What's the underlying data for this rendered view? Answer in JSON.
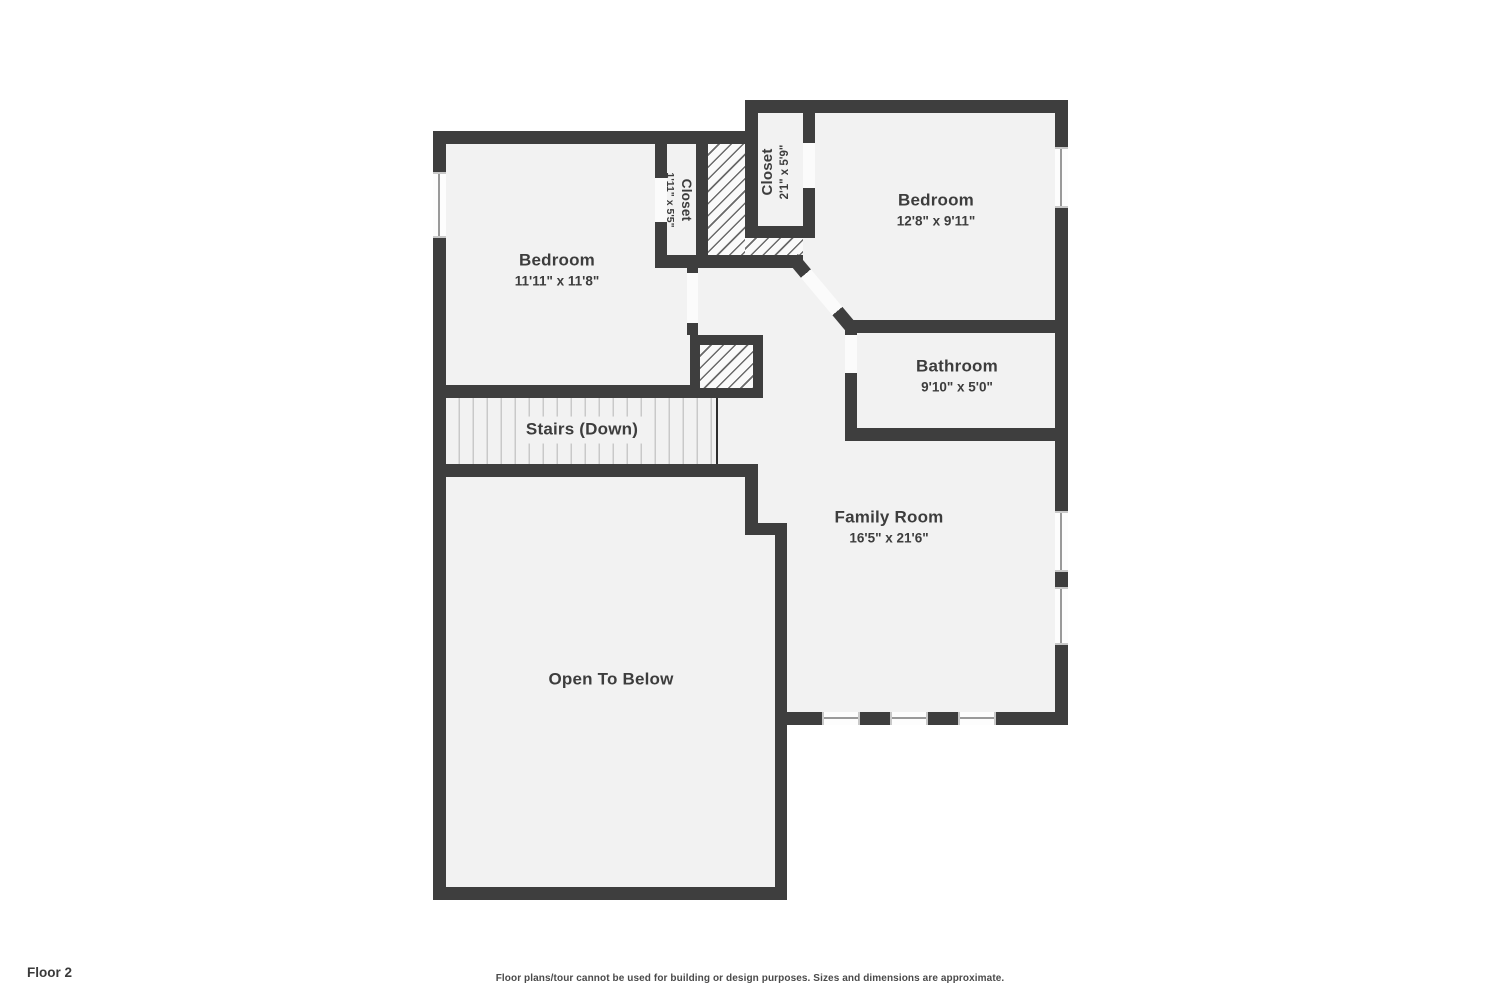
{
  "floor_label": "Floor 2",
  "disclaimer": "Floor plans/tour cannot be used for building or design purposes. Sizes and dimensions are approximate.",
  "rooms": {
    "bedroom1": {
      "name": "Bedroom",
      "dims": "11'11\" x 11'8\""
    },
    "bedroom2": {
      "name": "Bedroom",
      "dims": "12'8\" x 9'11\""
    },
    "bathroom": {
      "name": "Bathroom",
      "dims": "9'10\" x 5'0\""
    },
    "family_room": {
      "name": "Family Room",
      "dims": "16'5\" x 21'6\""
    },
    "closet1": {
      "name": "Closet",
      "dims": "1'11\" x 5'5\""
    },
    "closet2": {
      "name": "Closet",
      "dims": "2'1\" x 5'9\""
    },
    "stairs": {
      "name": "Stairs (Down)"
    },
    "open_below": {
      "name": "Open To Below"
    }
  },
  "colors": {
    "wall": "#3e3e3e",
    "floor": "#f2f2f2",
    "door_gap": "#fbfbfb",
    "window_line": "#9a9a9a",
    "text": "#3d3d3d"
  }
}
